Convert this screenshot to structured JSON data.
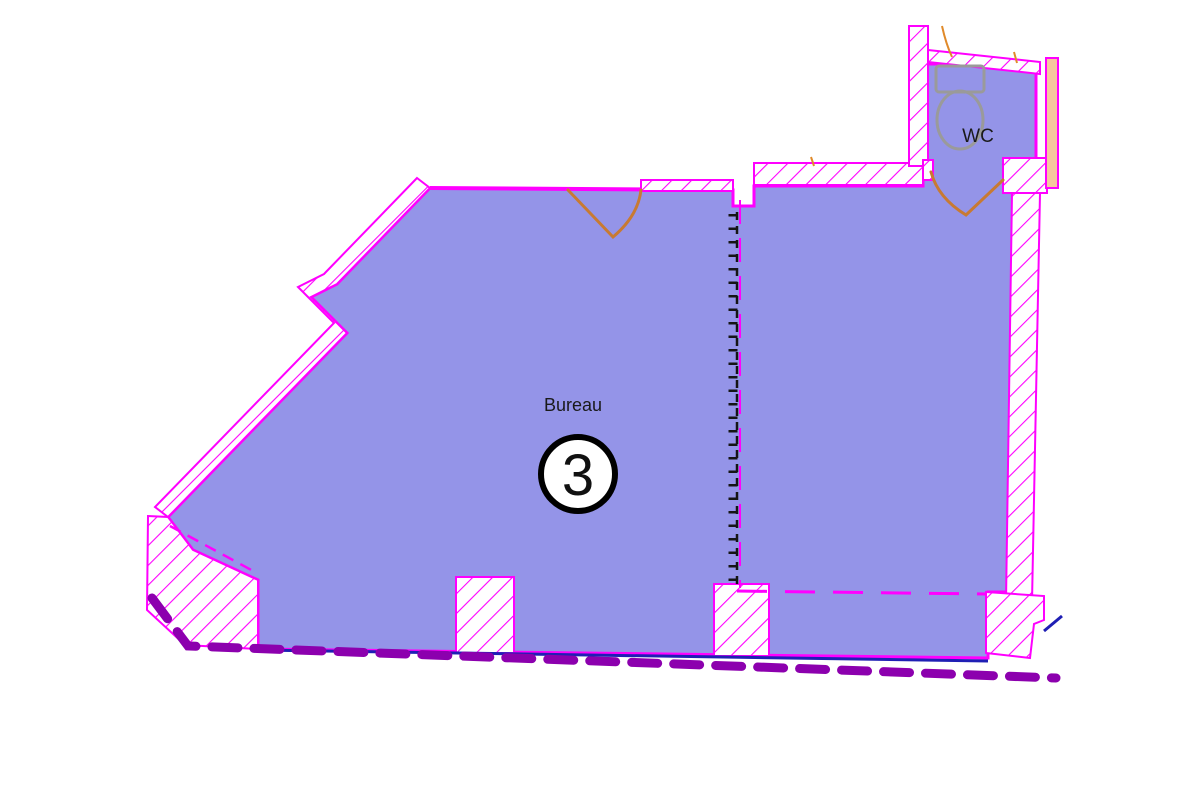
{
  "document": {
    "type": "architectural-floor-plan",
    "title": "Plan - Bureau 3 et WC"
  },
  "rooms": {
    "bureau": {
      "label": "Bureau",
      "number": "3"
    },
    "wc": {
      "label": "WC"
    }
  },
  "fixtures": [
    {
      "name": "toilet-icon",
      "room": "WC"
    }
  ],
  "symbols": {
    "door_swings": 2,
    "partition_line_style": "black dashed with tick marks",
    "boundary_line_style": "thick purple dashes",
    "wall_fill_style": "magenta diagonal hatch"
  },
  "colors": {
    "floor_fill": "#9494e8",
    "wall_outline": "#ff00ff",
    "wall_hatch": "#ff00ff",
    "door_swing": "#c87a32",
    "boundary_dashed": "#8c00ae",
    "baseline_blue": "#1f1fb4",
    "partition_black": "#151515",
    "adjacent_tan": "#f6c79e",
    "fixture_gray": "#9a9a9a",
    "label_text": "#1a1a1a",
    "number_circle_fill": "#ffffff",
    "number_circle_stroke": "#000000",
    "background": "#ffffff"
  }
}
